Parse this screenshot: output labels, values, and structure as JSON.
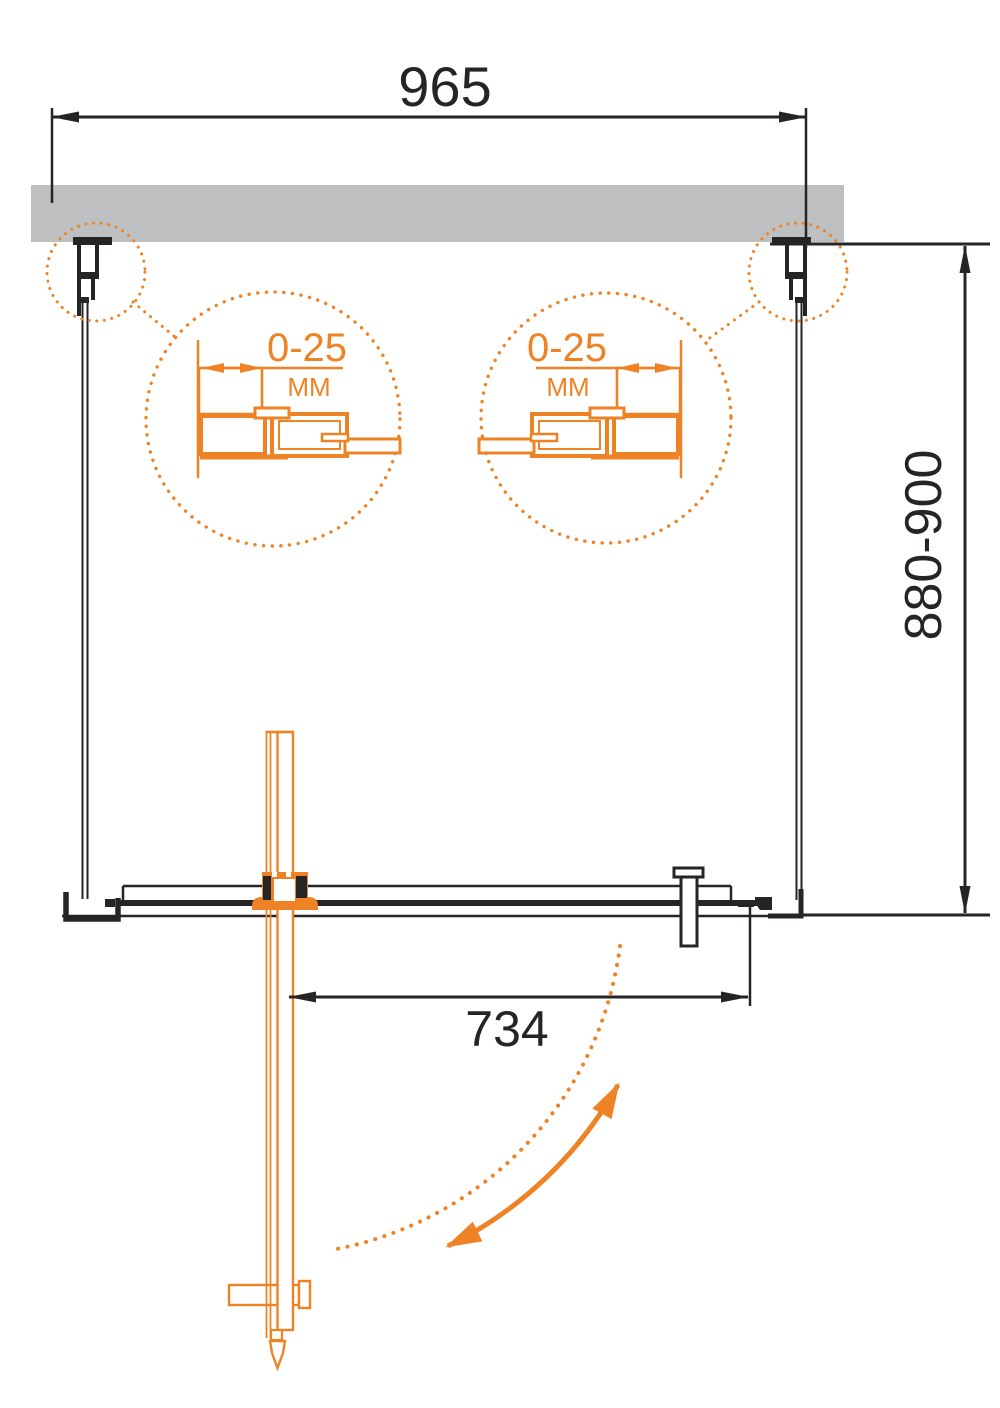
{
  "diagram": {
    "kind": "technical installation drawing, top view of pivot shower door"
  },
  "colors": {
    "line": "#272425",
    "accent": "#ee8325",
    "wall": "#bdbfc1",
    "background": "#ffffff"
  },
  "dimensions": {
    "overall_width": {
      "label": "965"
    },
    "depth": {
      "label": "880-900"
    },
    "door_width": {
      "label": "734"
    }
  },
  "details": {
    "left": {
      "range": "0-25",
      "unit": "MM"
    },
    "right": {
      "range": "0-25",
      "unit": "MM"
    }
  }
}
